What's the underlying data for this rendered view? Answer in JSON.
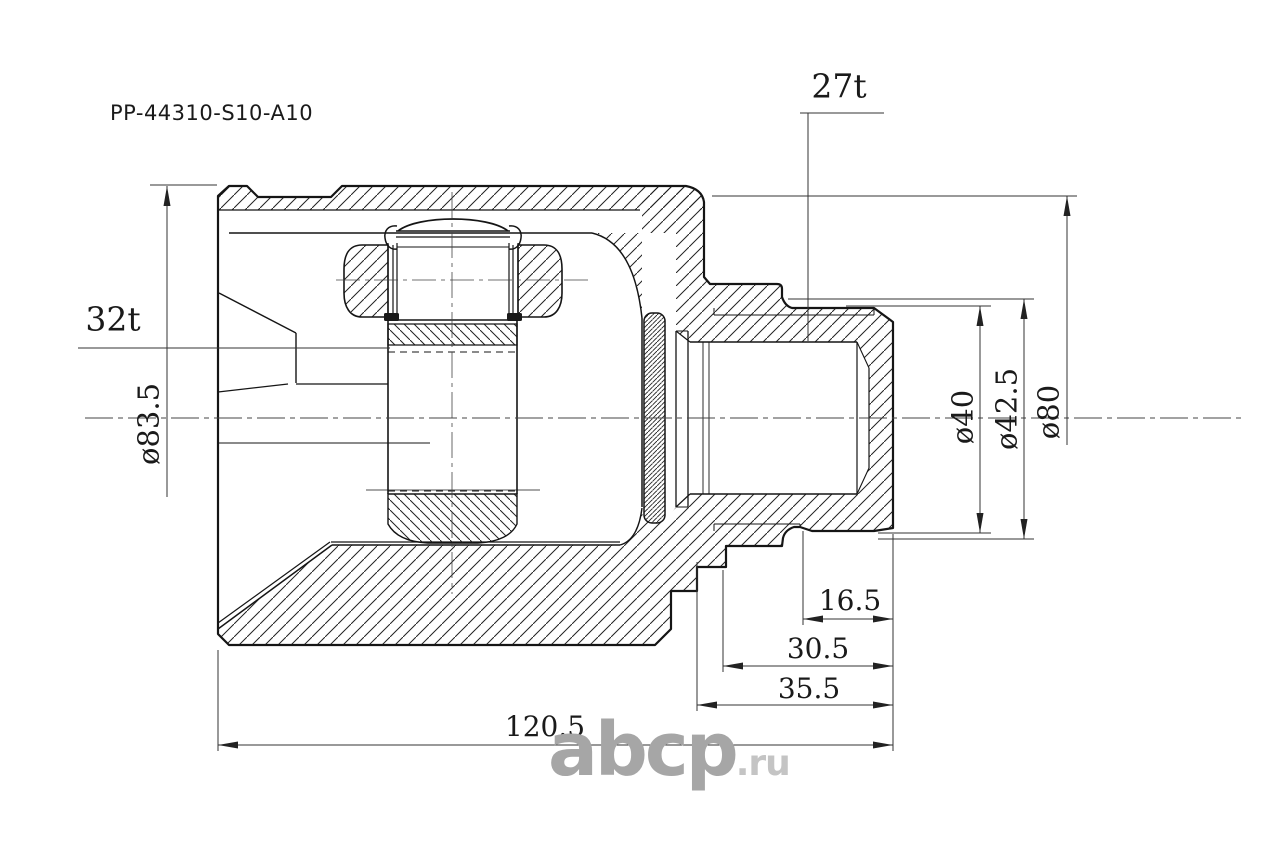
{
  "drawing": {
    "part_number": "PP-44310-S10-A10",
    "labels": {
      "shaft_spline_count": "27t",
      "hub_spline_count": "32t"
    },
    "dimensions": {
      "housing_od": "ø83.5",
      "shaft_od": "ø40",
      "ring_od": "ø42.5",
      "flange_od": "ø80",
      "groove_to_end": "16.5",
      "spline_length": "30.5",
      "shaft_length": "35.5",
      "total_length": "120.5"
    },
    "watermark": {
      "brand": "abcp",
      "tld": ".ru"
    },
    "colors": {
      "line": "#151515",
      "dim_line": "#333333",
      "watermark_gray": "#a6a6a6",
      "watermark_light": "#c4c4c4",
      "background": "#ffffff"
    }
  }
}
